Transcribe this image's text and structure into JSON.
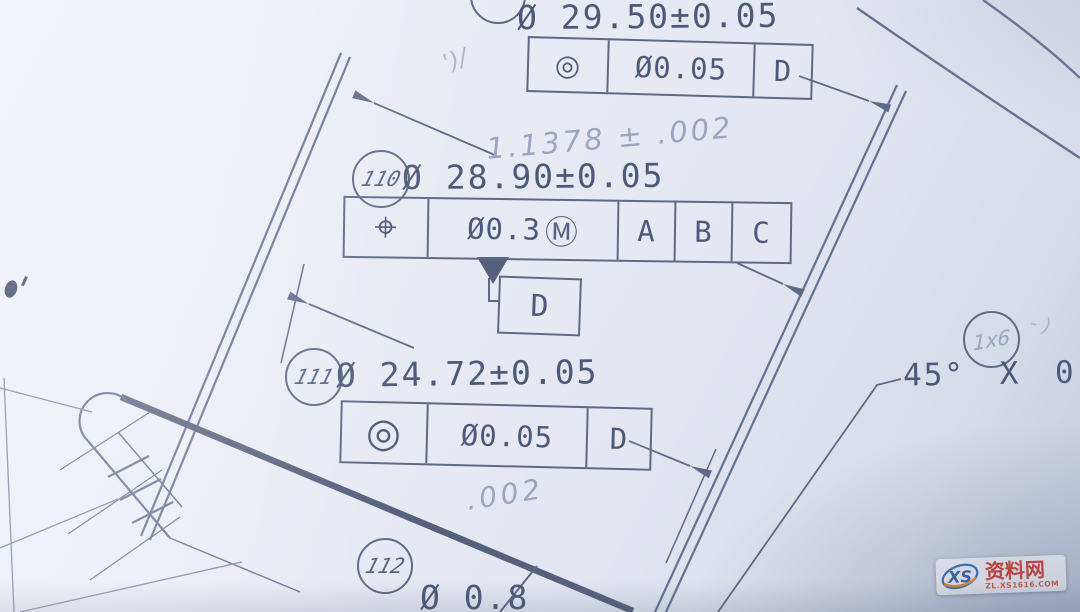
{
  "drawing": {
    "type": "engineering-drawing-photo",
    "ink_color": "#5c6a88",
    "pencil_color": "#9aa5c0",
    "callouts": {
      "c109": {
        "dimension": "Ø 29.50±0.05",
        "fcf": {
          "symbol": "◎",
          "symbol_name": "concentricity",
          "tolerance": "Ø0.05",
          "datum": "D"
        }
      },
      "c110": {
        "balloon": "110",
        "dimension": "Ø 28.90±0.05",
        "fcf": {
          "symbol": "⌖",
          "symbol_name": "position",
          "tolerance": "Ø0.3",
          "modifier": "Ⓜ",
          "datums": [
            "A",
            "B",
            "C"
          ]
        },
        "datum_flag": "D"
      },
      "c111": {
        "balloon": "111",
        "dimension": "Ø 24.72±0.05",
        "fcf": {
          "symbol": "◎",
          "symbol_name": "concentricity",
          "tolerance": "Ø0.05",
          "datum": "D"
        }
      },
      "c112": {
        "balloon": "112",
        "dimension": "Ø 0.8"
      },
      "chamfer": {
        "balloon_handwritten": "1x6",
        "text": "45° X 0."
      }
    },
    "handwritten": {
      "note1": "1.1378 ± .002",
      "note2": ".002",
      "mark1": "')/",
      "mark2": "- )"
    },
    "watermark": {
      "logo": "XS",
      "name": "资料网",
      "url": "ZL.XS1616.COM"
    }
  }
}
